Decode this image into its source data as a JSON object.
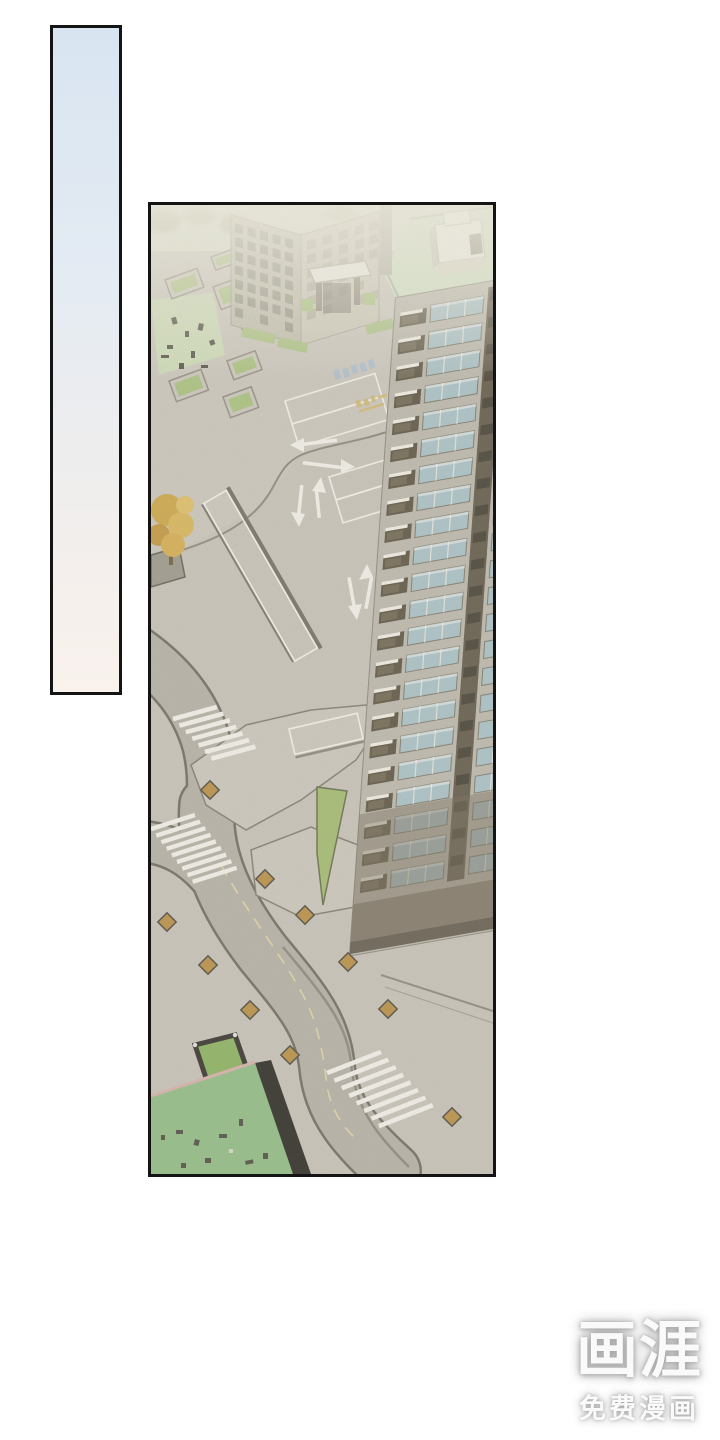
{
  "page": {
    "width": 720,
    "height": 1440,
    "background": "#ffffff"
  },
  "panels": {
    "sky": {
      "border_color": "#141414",
      "gradient_top": "#d8e5f1",
      "gradient_bottom": "#f9f2ed"
    },
    "city": {
      "border_color": "#141414",
      "description": "isometric aerial view of an apartment complex: high-rise tower with balconies, mid-rise block, entrance gate, roads with arrows, crosswalks, parking stalls, lawns and planters"
    }
  },
  "palette": {
    "page_bg": "#ffffff",
    "panel_border": "#141414",
    "sky_top": "#d8e5f1",
    "sky_bottom": "#f9f2ed",
    "pavement": "#c9c5bc",
    "pavement_light": "#cdc9c0",
    "road": "#b5b1a8",
    "road_edge": "#6b685f",
    "marking": "#f6f5f0",
    "center_line": "#e3d7a6",
    "lawn_pale": "#cfdfba",
    "lawn_bright": "#8fbe85",
    "hedge": "#a9c47e",
    "wedge_green": "#a3bd6e",
    "roof_green": "#d3e4c6",
    "facade": "#bdb9af",
    "window_glass": "#a9c3cb",
    "balcony_dark": "#57503f",
    "strip_dark": "#5d5546",
    "base_dark": "#7e7567",
    "planter_orange": "#b98e41",
    "planter_frame": "#4a463c",
    "tree_gold": "#d3a94a",
    "midrise_window": "#8f9081",
    "white_struct": "#f2f1e8",
    "figure_dark": "#4a493f",
    "watermark": "#fafafa"
  },
  "watermark": {
    "logo": "画涯",
    "subtitle": "免费漫画"
  }
}
